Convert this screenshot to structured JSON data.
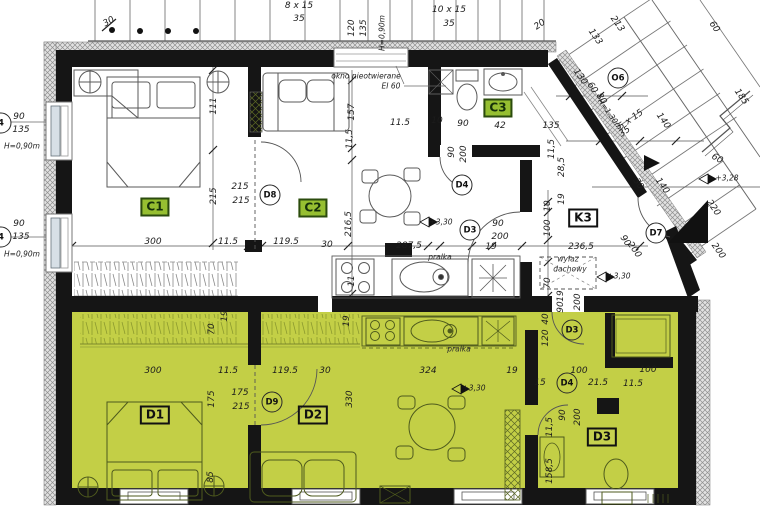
{
  "meta": {
    "type": "architectural-floor-plan"
  },
  "colors": {
    "floor_green": "#c3cf46",
    "wall_black": "#151515",
    "room_tag_green": "#96bf31",
    "line_gray": "#666666"
  },
  "room_tags": [
    {
      "t": "C1",
      "x": 155,
      "y": 207,
      "v": "green"
    },
    {
      "t": "C2",
      "x": 313,
      "y": 208,
      "v": "green"
    },
    {
      "t": "C3",
      "x": 498,
      "y": 108,
      "v": "green"
    },
    {
      "t": "K3",
      "x": 583,
      "y": 218,
      "v": "white"
    },
    {
      "t": "D1",
      "x": 155,
      "y": 415,
      "v": "outline"
    },
    {
      "t": "D2",
      "x": 313,
      "y": 415,
      "v": "outline"
    },
    {
      "t": "D3",
      "x": 602,
      "y": 437,
      "v": "outline"
    }
  ],
  "door_tags": [
    {
      "t": "D8",
      "x": 270,
      "y": 195,
      "v": ""
    },
    {
      "t": "D4",
      "x": 462,
      "y": 185,
      "v": ""
    },
    {
      "t": "D3",
      "x": 470,
      "y": 230,
      "v": ""
    },
    {
      "t": "D7",
      "x": 656,
      "y": 233,
      "v": ""
    },
    {
      "t": "O6",
      "x": 618,
      "y": 78,
      "v": ""
    },
    {
      "t": "D9",
      "x": 272,
      "y": 402,
      "v": "g"
    },
    {
      "t": "D3",
      "x": 572,
      "y": 330,
      "v": "g"
    },
    {
      "t": "D4",
      "x": 567,
      "y": 383,
      "v": "g"
    },
    {
      "t": "4",
      "x": 1,
      "y": 123,
      "v": ""
    },
    {
      "t": "4",
      "x": 1,
      "y": 237,
      "v": ""
    }
  ],
  "dim_labels": [
    {
      "t": "8 x 15",
      "x": 299,
      "y": 6
    },
    {
      "t": "35",
      "x": 299,
      "y": 19
    },
    {
      "t": "30",
      "x": 109,
      "y": 22,
      "r": -30
    },
    {
      "t": "10 x 15",
      "x": 449,
      "y": 10
    },
    {
      "t": "35",
      "x": 449,
      "y": 24
    },
    {
      "t": "120",
      "x": 352,
      "y": 28,
      "r": -90
    },
    {
      "t": "135",
      "x": 364,
      "y": 28,
      "r": -90
    },
    {
      "t": "H=0,90m",
      "x": 382,
      "y": 33,
      "r": -90,
      "c": "s"
    },
    {
      "t": "20",
      "x": 540,
      "y": 25,
      "r": -35
    },
    {
      "t": "213",
      "x": 617,
      "y": 24,
      "r": 55
    },
    {
      "t": "133",
      "x": 595,
      "y": 37,
      "r": 55
    },
    {
      "t": "60",
      "x": 714,
      "y": 27,
      "r": 55
    },
    {
      "t": "185",
      "x": 741,
      "y": 97,
      "r": 55
    },
    {
      "t": "130",
      "x": 580,
      "y": 77,
      "r": 55
    },
    {
      "t": "60",
      "x": 592,
      "y": 88,
      "r": 55
    },
    {
      "t": "80",
      "x": 601,
      "y": 99,
      "r": 55
    },
    {
      "t": "H=1,30m",
      "x": 610,
      "y": 114,
      "r": 55,
      "c": "s"
    },
    {
      "t": "5 x 15",
      "x": 631,
      "y": 120,
      "r": -35
    },
    {
      "t": "35",
      "x": 625,
      "y": 132,
      "r": -35
    },
    {
      "t": "140",
      "x": 663,
      "y": 121,
      "r": 55
    },
    {
      "t": "60",
      "x": 717,
      "y": 159,
      "r": 30
    },
    {
      "t": "+3,28",
      "x": 727,
      "y": 178,
      "c": "s"
    },
    {
      "t": "140",
      "x": 662,
      "y": 186,
      "r": 55
    },
    {
      "t": "220",
      "x": 713,
      "y": 208,
      "r": 55
    },
    {
      "t": "30",
      "x": 638,
      "y": 184,
      "r": 55
    },
    {
      "t": "200",
      "x": 718,
      "y": 251,
      "r": 55
    },
    {
      "t": "90",
      "x": 625,
      "y": 241,
      "r": 55
    },
    {
      "t": "200",
      "x": 634,
      "y": 250,
      "r": 55
    },
    {
      "t": "90",
      "x": 19,
      "y": 117
    },
    {
      "t": "135",
      "x": 21,
      "y": 130
    },
    {
      "t": "H=0,90m",
      "x": 22,
      "y": 146,
      "c": "s"
    },
    {
      "t": "90",
      "x": 19,
      "y": 224
    },
    {
      "t": "135",
      "x": 21,
      "y": 237
    },
    {
      "t": "H=0,90m",
      "x": 22,
      "y": 254,
      "c": "s"
    },
    {
      "t": "111",
      "x": 214,
      "y": 106,
      "r": -90
    },
    {
      "t": "215",
      "x": 214,
      "y": 196,
      "r": -90
    },
    {
      "t": "215",
      "x": 240,
      "y": 187
    },
    {
      "t": "215",
      "x": 241,
      "y": 201
    },
    {
      "t": "300",
      "x": 153,
      "y": 242
    },
    {
      "t": "11.5",
      "x": 228,
      "y": 242
    },
    {
      "t": "119.5",
      "x": 286,
      "y": 242
    },
    {
      "t": "30",
      "x": 327,
      "y": 245
    },
    {
      "t": "157",
      "x": 352,
      "y": 112,
      "r": -90
    },
    {
      "t": "11,5",
      "x": 350,
      "y": 139,
      "r": -90
    },
    {
      "t": "216,5",
      "x": 349,
      "y": 224,
      "r": -90
    },
    {
      "t": "11",
      "x": 352,
      "y": 281,
      "r": -90
    },
    {
      "t": "okno nieotwierane",
      "x": 366,
      "y": 76,
      "c": "s"
    },
    {
      "t": "EI 60",
      "x": 391,
      "y": 86,
      "c": "s"
    },
    {
      "t": "11.5",
      "x": 400,
      "y": 123
    },
    {
      "t": "10",
      "x": 437,
      "y": 121
    },
    {
      "t": "90",
      "x": 463,
      "y": 124
    },
    {
      "t": "42",
      "x": 500,
      "y": 126
    },
    {
      "t": "135",
      "x": 551,
      "y": 126
    },
    {
      "t": "90",
      "x": 452,
      "y": 152,
      "r": -90
    },
    {
      "t": "200",
      "x": 464,
      "y": 154,
      "r": -90
    },
    {
      "t": "11,5",
      "x": 552,
      "y": 149,
      "r": -90
    },
    {
      "t": "28,5",
      "x": 562,
      "y": 167,
      "r": -90
    },
    {
      "t": "19",
      "x": 562,
      "y": 199,
      "r": -90
    },
    {
      "t": "10",
      "x": 548,
      "y": 206,
      "r": -90
    },
    {
      "t": "100",
      "x": 548,
      "y": 228,
      "r": -90
    },
    {
      "t": "70",
      "x": 548,
      "y": 283,
      "r": -90
    },
    {
      "t": "287,5",
      "x": 409,
      "y": 246
    },
    {
      "t": "19",
      "x": 491,
      "y": 247
    },
    {
      "t": "90",
      "x": 498,
      "y": 224
    },
    {
      "t": "200",
      "x": 500,
      "y": 237
    },
    {
      "t": "+3,30",
      "x": 441,
      "y": 222,
      "c": "s"
    },
    {
      "t": "236,5",
      "x": 581,
      "y": 247
    },
    {
      "t": "wyłaz",
      "x": 568,
      "y": 259,
      "c": "si"
    },
    {
      "t": "dachowy",
      "x": 570,
      "y": 269,
      "c": "si"
    },
    {
      "t": "+3,30",
      "x": 619,
      "y": 276,
      "c": "s"
    },
    {
      "t": "pralka",
      "x": 440,
      "y": 257,
      "c": "si"
    },
    {
      "t": "70",
      "x": 212,
      "y": 329,
      "r": -90
    },
    {
      "t": "19",
      "x": 225,
      "y": 316,
      "r": -90
    },
    {
      "t": "19",
      "x": 347,
      "y": 321,
      "r": -90
    },
    {
      "t": "300",
      "x": 153,
      "y": 371
    },
    {
      "t": "11.5",
      "x": 228,
      "y": 371
    },
    {
      "t": "119.5",
      "x": 285,
      "y": 371
    },
    {
      "t": "30",
      "x": 325,
      "y": 371
    },
    {
      "t": "175",
      "x": 212,
      "y": 399,
      "r": -90
    },
    {
      "t": "175",
      "x": 240,
      "y": 393
    },
    {
      "t": "215",
      "x": 241,
      "y": 407
    },
    {
      "t": "85",
      "x": 211,
      "y": 477,
      "r": -90
    },
    {
      "t": "330",
      "x": 350,
      "y": 399,
      "r": -90
    },
    {
      "t": "324",
      "x": 428,
      "y": 371
    },
    {
      "t": "19",
      "x": 512,
      "y": 371
    },
    {
      "t": "15",
      "x": 540,
      "y": 383
    },
    {
      "t": "100",
      "x": 579,
      "y": 371
    },
    {
      "t": "21.5",
      "x": 598,
      "y": 383
    },
    {
      "t": "11.5",
      "x": 633,
      "y": 384
    },
    {
      "t": "100",
      "x": 648,
      "y": 370
    },
    {
      "t": "+3,30",
      "x": 474,
      "y": 388,
      "c": "s"
    },
    {
      "t": "pralka",
      "x": 459,
      "y": 349,
      "c": "si"
    },
    {
      "t": "40",
      "x": 546,
      "y": 319,
      "r": -90
    },
    {
      "t": "120",
      "x": 546,
      "y": 338,
      "r": -90
    },
    {
      "t": "19",
      "x": 561,
      "y": 296,
      "r": -90
    },
    {
      "t": "90",
      "x": 561,
      "y": 307,
      "r": -90
    },
    {
      "t": "200",
      "x": 578,
      "y": 302,
      "r": -90
    },
    {
      "t": "90",
      "x": 563,
      "y": 415,
      "r": -90
    },
    {
      "t": "200",
      "x": 578,
      "y": 417,
      "r": -90
    },
    {
      "t": "11,5",
      "x": 550,
      "y": 427,
      "r": -90
    },
    {
      "t": "158,5",
      "x": 550,
      "y": 471,
      "r": -90
    }
  ]
}
